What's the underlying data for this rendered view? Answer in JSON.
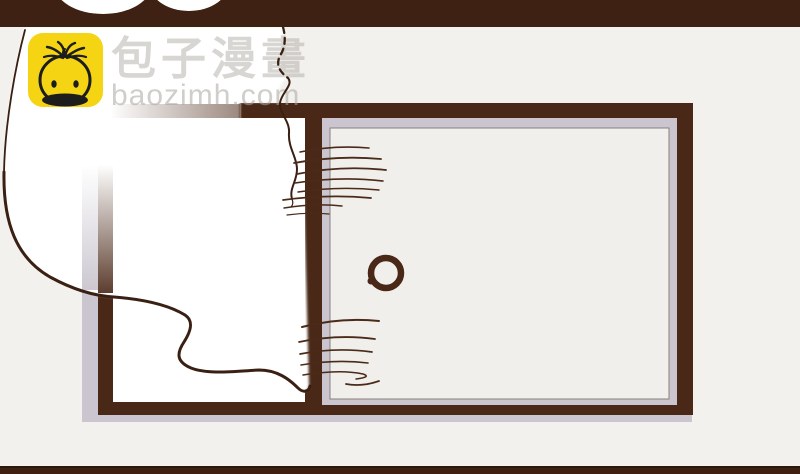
{
  "watermark": {
    "brand_cjk": "包子漫畫",
    "brand_domain": "baozimh.com",
    "logo_icon": "baozi-bun-face"
  },
  "colors": {
    "background": "#f2f1ed",
    "bar_brown": "#3e2112",
    "bar_line": "#2c190d",
    "frame_brown": "#4a2817",
    "ink": "#3a2013",
    "hair_brown": "#4a2a18",
    "sill_gray": "#cac5ce",
    "pane_beige": "#f1efeb",
    "pane_outline": "#86817d",
    "pane_white": "#ffffff",
    "cloud_white": "#ffffff",
    "logo_yellow": "#f5d414",
    "logo_ink": "#1d1d1b",
    "watermark_gray": "rgba(178,174,168,0.5)",
    "watermark_gray2": "rgba(170,166,160,0.55)"
  }
}
